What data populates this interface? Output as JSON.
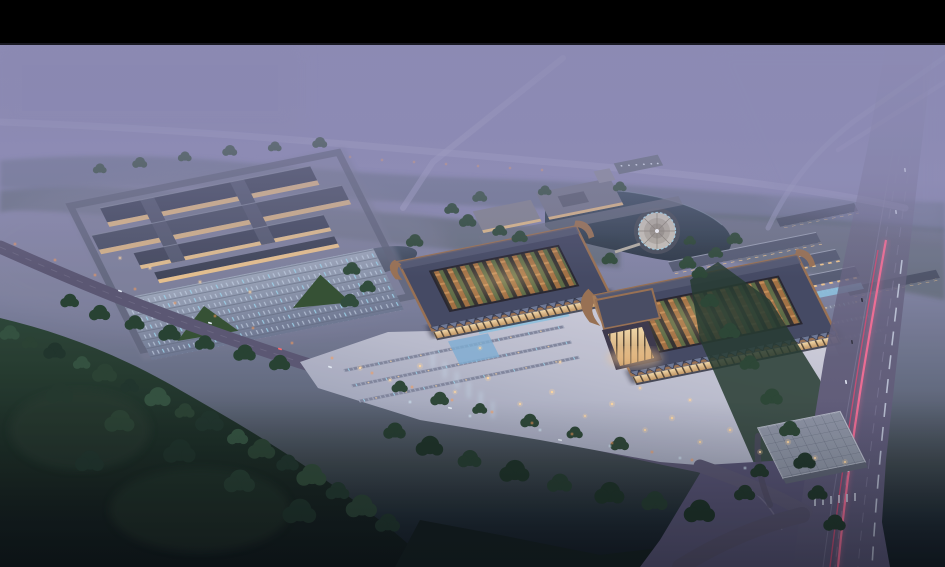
{
  "scene": {
    "description": "Dusk aerial architectural rendering of a large wholesale-market complex: two courtyard trade halls with upswept copper-edged roofs joined by a lit central gate, a bright front plaza with parking rows and skylights, a secondary market complex with parking lot on the west, a lake with a circular island pavilion, rows of shop buildings, an arterial road with car light trails on the east, access roads with orange streetlights, and dark woodland in the foreground under purple evening haze",
    "time_of_day": "dusk",
    "elements": {
      "letterbox": "black letterbox bar at top",
      "sky_fog": "purple evening haze over distant fields and roads",
      "west_complex": "secondary market buildings with lit arcades and parking lot",
      "trade_hall_west": "west trade hall with open courtyard roof",
      "trade_hall_east": "east trade hall with upswept roof wing",
      "central_gate": "brightly lit central gate atrium",
      "front_plaza": "light paved plaza with parking rows, skylights and fountains",
      "lake": "lake with circular island pavilion",
      "campus": "office campus beside the lake",
      "market_rows": "parallel rows of shop buildings",
      "glass_building": "glass-roofed building at the road junction",
      "highway": "arterial road with pink tail-light trails",
      "front_road": "curving access road with orange streetlights",
      "forest": "dark woodland foreground"
    }
  },
  "palette": {
    "letterbox": "#000000",
    "sky_fog": "#8e8cb5",
    "roof_slate": "#434860",
    "roof_copper": "#9a7150",
    "facade_glow": "#f2cf9a",
    "plaza_light": "#c6c5d3",
    "water": "#31404e",
    "forest": "#1e3126",
    "road": "#5a5670",
    "road_fog": "#a7a6c8",
    "trail_pink": "#ff6e95",
    "light_warm": "#ffd9a2",
    "parking_blue": "#9fd8ef",
    "tree_green": "#2c452f"
  }
}
